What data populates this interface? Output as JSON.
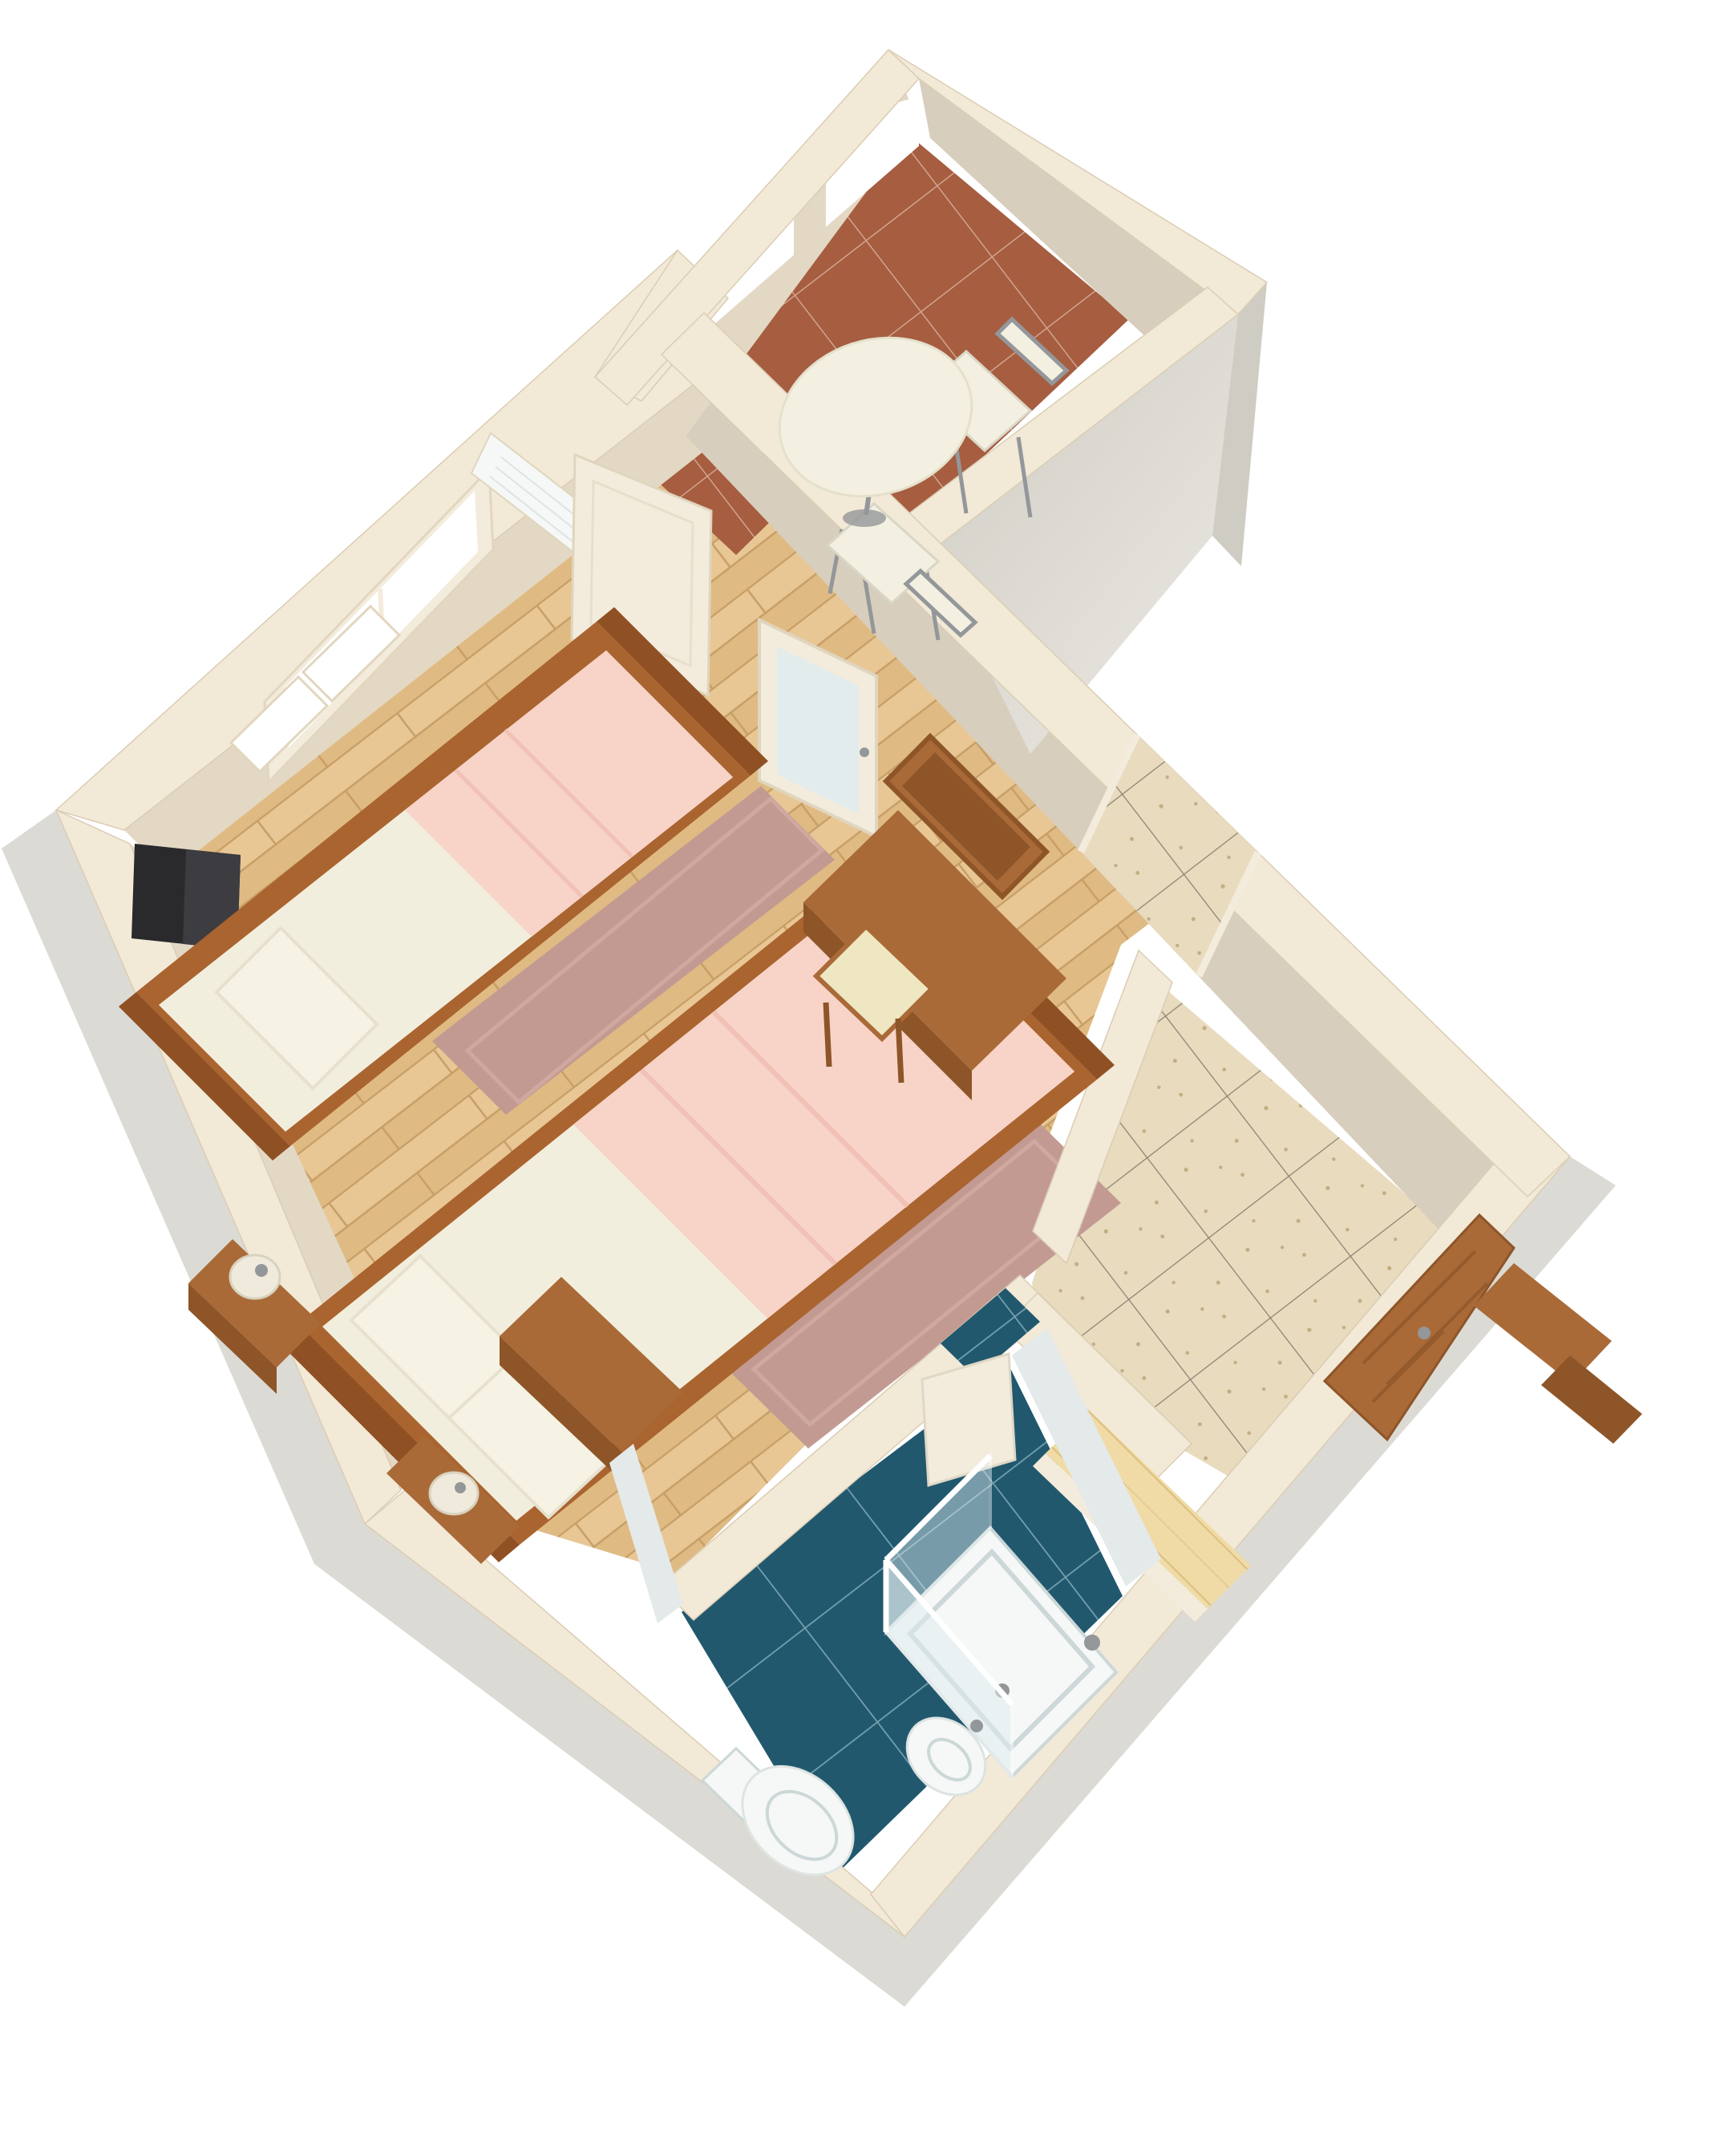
{
  "scene": {
    "type": "3d-floor-plan-render",
    "view": "isometric-birdseye-rotated",
    "description": "Furnished studio apartment 3D floor plan on white background",
    "rooms": [
      {
        "id": "bedroom",
        "name": "Bedroom / living area",
        "floor": "light wood planks"
      },
      {
        "id": "dining-nook",
        "name": "Dining nook behind arched wall",
        "floor": "terracotta tile"
      },
      {
        "id": "vestibule",
        "name": "Entry vestibule",
        "floor": "terracotta tile"
      },
      {
        "id": "hallway",
        "name": "Hallway with closet",
        "floor": "speckled beige tile"
      },
      {
        "id": "bathroom",
        "name": "Bathroom",
        "floor": "dark blue tile"
      }
    ],
    "furniture": [
      "single bed with pink blanket and pillow",
      "double bed with pink blanket and two pillows",
      "nightstand with round lamp",
      "low bench with second lamp at bed foot",
      "wall-mounted black TV",
      "desk with wall mirror and cream stool",
      "wooden dresser",
      "two mauve area rugs",
      "round white dining table",
      "two white metal-frame dining chairs",
      "air conditioner above window",
      "casement window with two open sashes",
      "open cream interior door leaves",
      "glass vestibule door",
      "wooden entry door with handle",
      "light wood closet counter",
      "wooden closet panels",
      "shower cabin with glass enclosure and tray",
      "toilet",
      "bidet",
      "open bathroom door leaf"
    ]
  },
  "palette": {
    "background": "#ffffff",
    "wall_top": "#f2e9d7",
    "wall_face": "#e3d8c4",
    "wall_face_dark": "#d8cebd",
    "wall_grey": "#cfccc3",
    "wall_grey_light": "#eae8e2",
    "shadow": "#d6d3cc",
    "floor_wood": "#e8c795",
    "floor_wood_dark": "#dfbb83",
    "wood_seam": "#c79e66",
    "terracotta": "#a65d40",
    "terracotta_grout": "#d8b09c",
    "hall_tile": "#e9dbbe",
    "hall_grout": "#8a8272",
    "hall_speckle": "#c2ae83",
    "bath_tile": "#21586e",
    "bath_grout": "#7fa8b6",
    "closet_wood": "#f0dba6",
    "closet_seam": "#d4b370",
    "bed_wood": "#aa6430",
    "bed_wood_dark": "#8f5024",
    "mattress": "#f2eedd",
    "mattress_shadow": "#e2ddc8",
    "pillow": "#f6f3e4",
    "blanket": "#f8d3c7",
    "blanket_fold": "#efbfb2",
    "rug": "#c39a92",
    "rug_light": "#d2aba3",
    "furniture_wood": "#a96a38",
    "furniture_wood_dark": "#8d5528",
    "cushion": "#efe7c2",
    "tv": "#2a2a2d",
    "tv_light": "#3c3c41",
    "metal": "#94979a",
    "fixture": "#f5f8f6",
    "fixture_shadow": "#ccd7d8",
    "glass": "#dfecef",
    "tile_wall": "#e4e9ea",
    "lamp": "#efeadb",
    "table_top": "#f3f0e1",
    "door_cream": "#f3ecdc",
    "white": "#ffffff"
  }
}
